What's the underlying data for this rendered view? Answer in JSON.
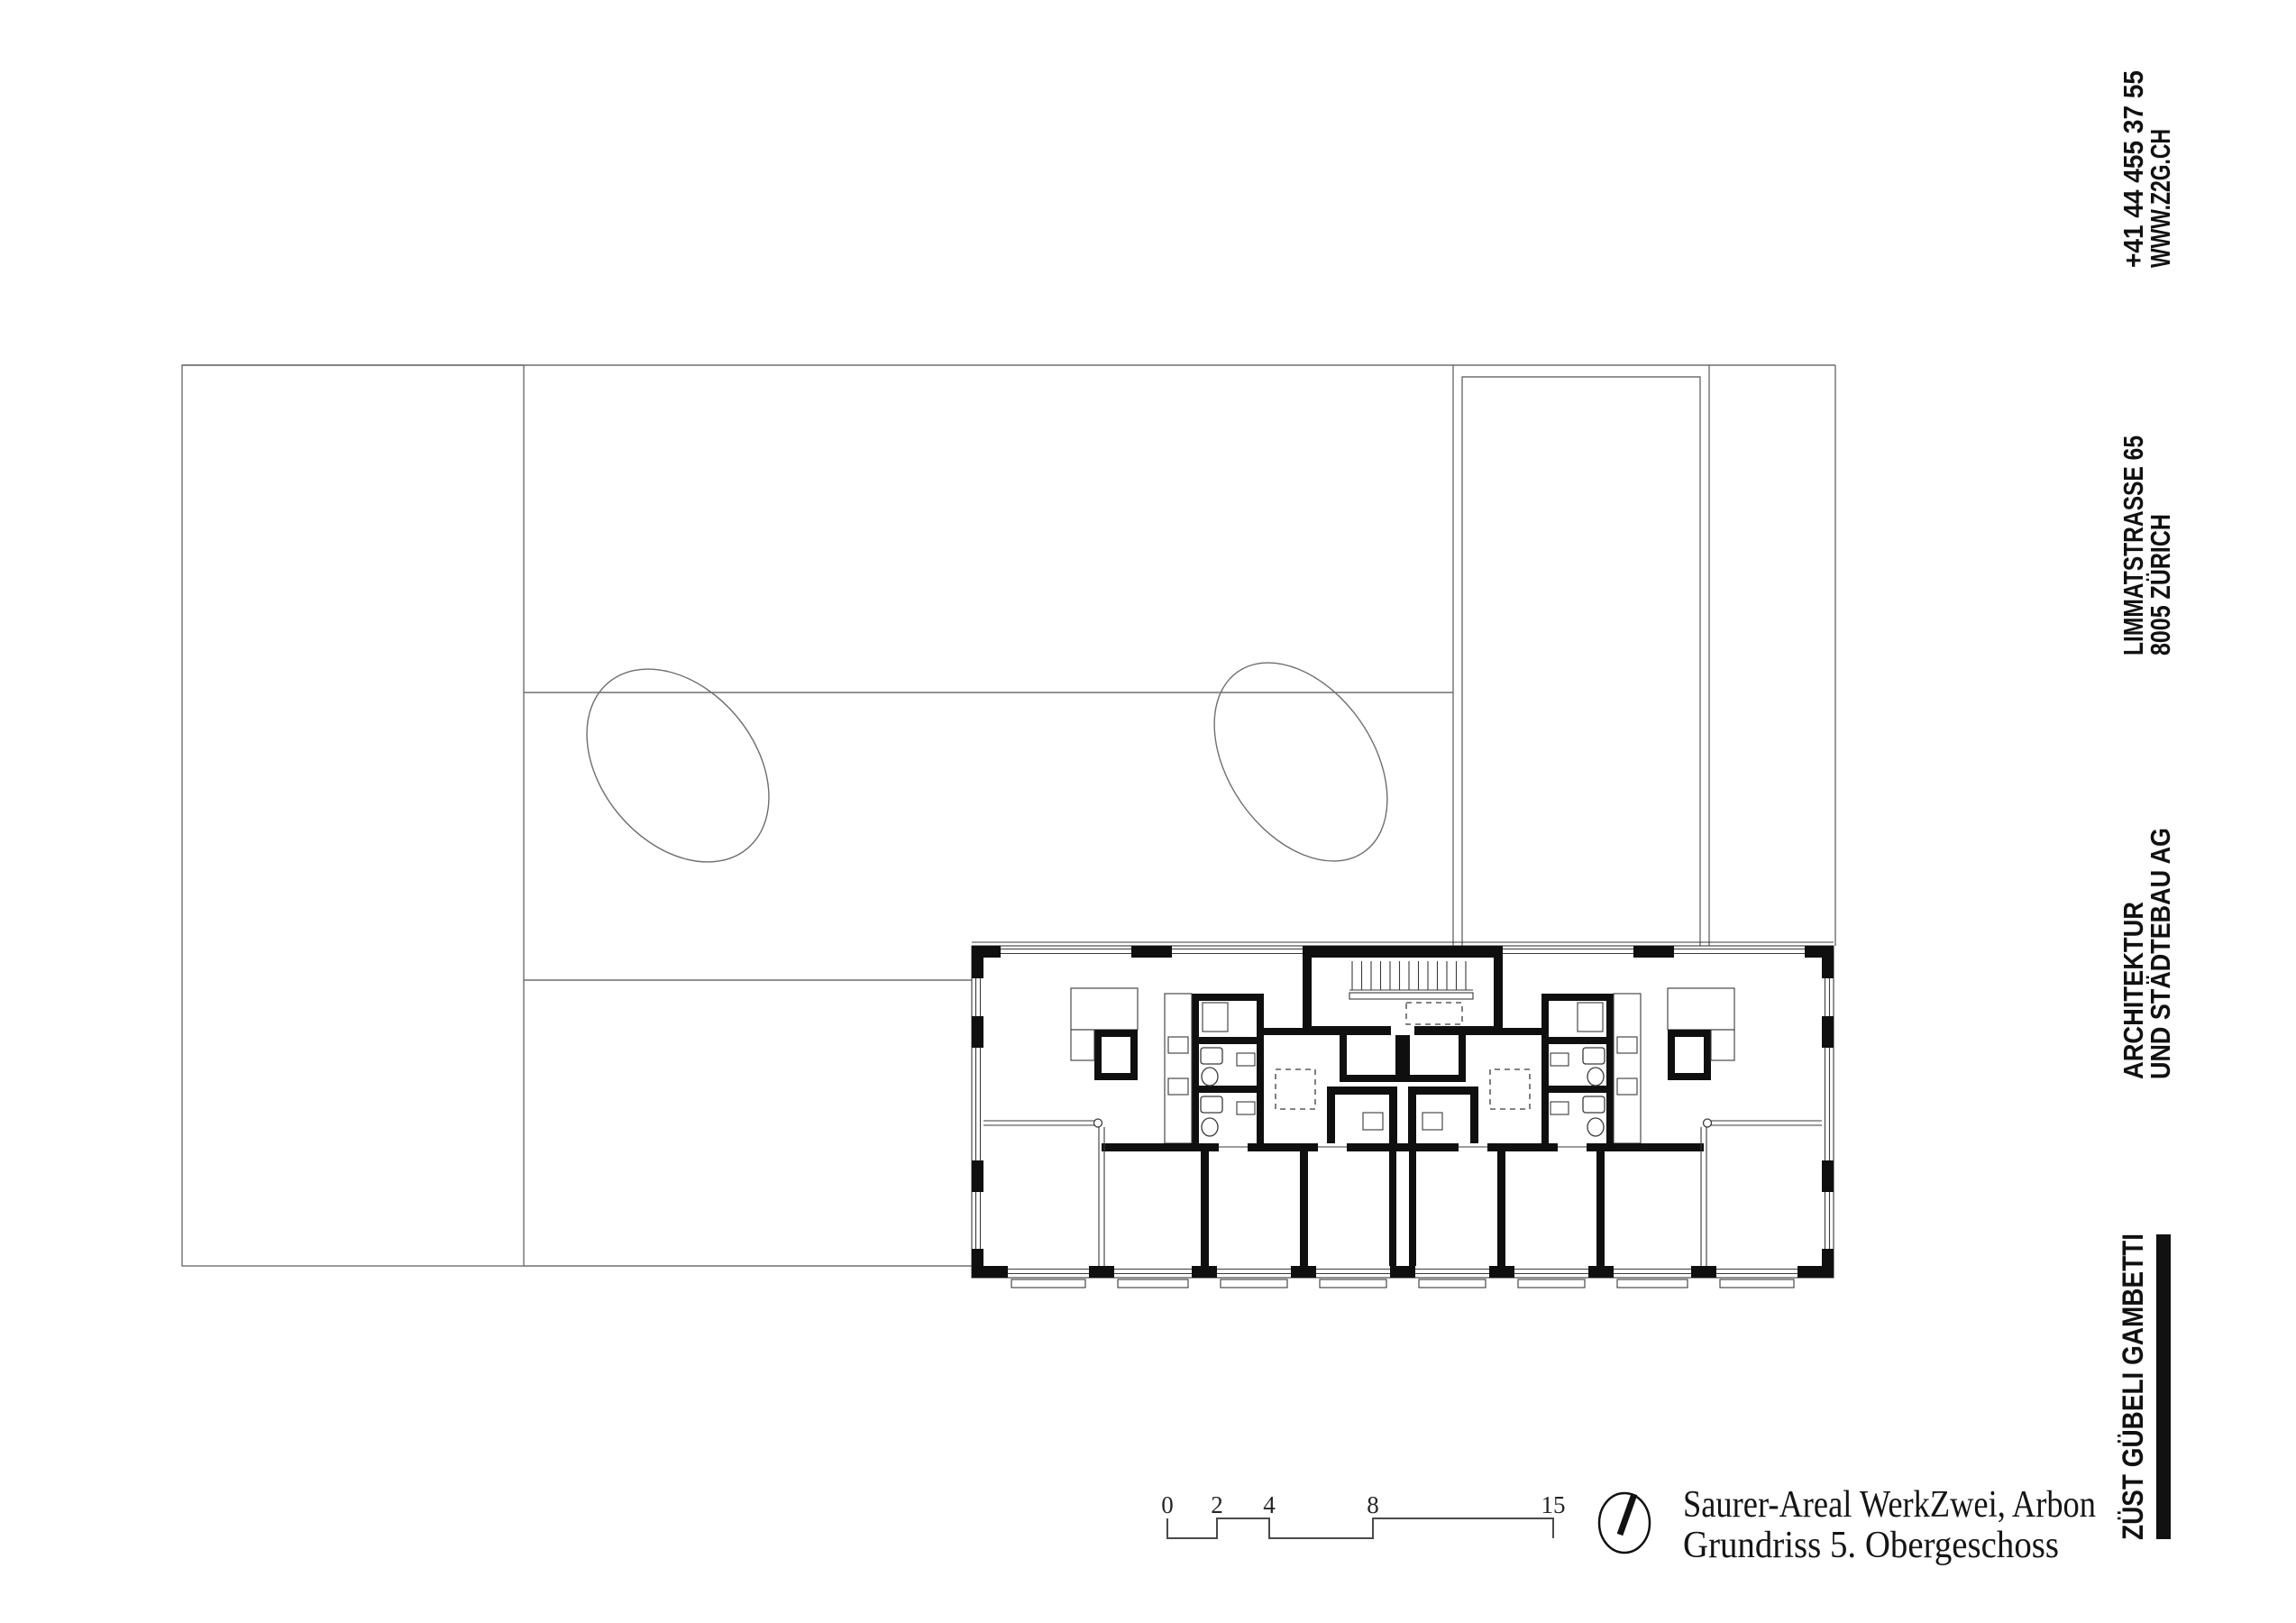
{
  "sidebar": {
    "contact": {
      "phone": "+41 44 455 37 55",
      "website": "WWW.Z2G.CH"
    },
    "address": {
      "street": "LIMMATSTRASSE 65",
      "city": "8005 ZÜRICH"
    },
    "firm": {
      "line1": "ARCHITEKTUR",
      "line2": "UND STÄDTEBAU AG"
    },
    "logo": "ZÜST GÜBELI GAMBETTI"
  },
  "title_block": {
    "project": "Saurer-Areal WerkZwei, Arbon",
    "drawing": "Grundriss 5. Obergeschoss"
  },
  "scale_bar": {
    "labels": [
      "0",
      "2",
      "4",
      "8",
      "15"
    ]
  },
  "colors": {
    "ink": "#0f0f0f",
    "site_line": "#6f6f6f",
    "plan_line": "#3a3a3a"
  }
}
